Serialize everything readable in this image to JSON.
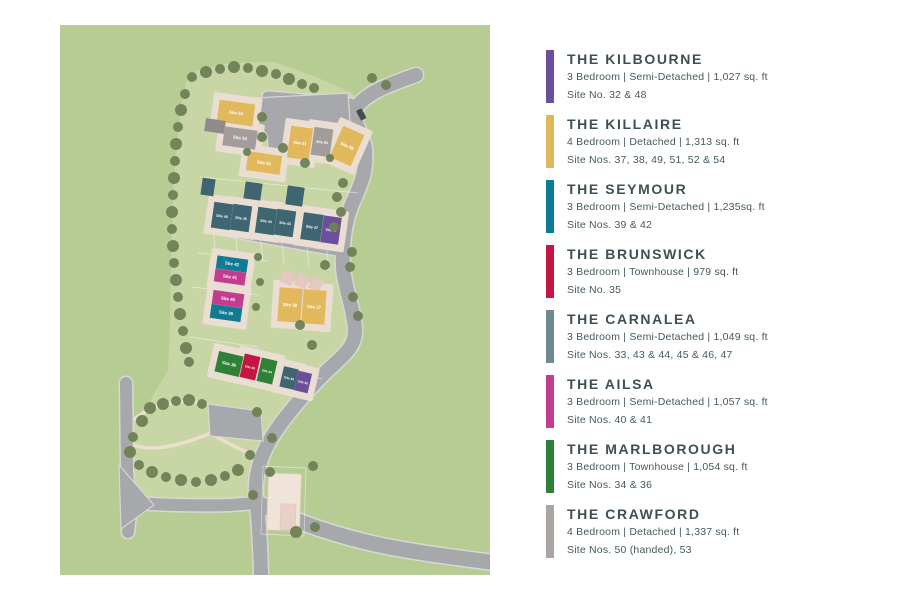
{
  "legend": {
    "items": [
      {
        "name": "THE KILBOURNE",
        "specs": "3 Bedroom | Semi-Detached | 1,027 sq. ft",
        "sites": "Site No. 32 & 48",
        "color": "#6a4f9a"
      },
      {
        "name": "THE KILLAIRE",
        "specs": "4 Bedroom | Detached | 1,313 sq. ft",
        "sites": "Site Nos. 37, 38, 49, 51, 52 & 54",
        "color": "#e0b85c"
      },
      {
        "name": "THE SEYMOUR",
        "specs": "3 Bedroom | Semi-Detached | 1,235sq. ft",
        "sites": "Site Nos. 39 & 42",
        "color": "#0b7a94"
      },
      {
        "name": "THE BRUNSWICK",
        "specs": "3 Bedroom | Townhouse | 979 sq. ft",
        "sites": "Site No. 35",
        "color": "#c51544"
      },
      {
        "name": "THE CARNALEA",
        "specs": "3 Bedroom | Semi-Detached | 1,049 sq. ft",
        "sites": "Site Nos. 33, 43 & 44, 45 & 46, 47",
        "color": "#6c8a8f"
      },
      {
        "name": "THE AILSA",
        "specs": "3 Bedroom | Semi-Detached | 1,057 sq. ft",
        "sites": "Site Nos. 40 & 41",
        "color": "#c23d8f"
      },
      {
        "name": "THE MARLBOROUGH",
        "specs": "3 Bedroom | Townhouse | 1,054 sq. ft",
        "sites": "Site Nos. 34 & 36",
        "color": "#2c8136"
      },
      {
        "name": "THE CRAWFORD",
        "specs": "4 Bedroom | Detached | 1,337 sq. ft",
        "sites": "Site Nos. 50 (handed), 53",
        "color": "#aaa5a3"
      }
    ]
  },
  "map": {
    "colors": {
      "kilbourne": "#6a4f9a",
      "killaire": "#e2b85c",
      "seymour": "#0e7b93",
      "brunswick": "#c51544",
      "carnalea": "#3f6472",
      "ailsa": "#c33d8f",
      "marlborough": "#2e8136",
      "crawford": "#a29d9b",
      "garage_gray": "#908b89",
      "garage_slate": "#3f6472",
      "garage_pink": "#e5c8c0",
      "existing": "#f0e4d9",
      "existing_annex": "#e9d0c7",
      "pad": "#eaddd2",
      "tree": "#6e7f54",
      "grass_outer": "#b7cc93",
      "grass_site": "#c8d6a6",
      "road": "#a7a8ab",
      "road_edge": "#d8d8d2",
      "path": "#ecdfcc",
      "label_text": "#ffffff",
      "car": "#474b51"
    },
    "houses": [
      {
        "label": "Site 54",
        "type": "killaire",
        "cx": 176,
        "cy": 88,
        "w": 36,
        "h": 22,
        "rot": 8
      },
      {
        "label": "",
        "type": "garage_gray",
        "cx": 155,
        "cy": 101,
        "w": 20,
        "h": 13,
        "rot": 8
      },
      {
        "label": "Site 53",
        "type": "crawford",
        "cx": 180,
        "cy": 113,
        "w": 33,
        "h": 19,
        "rot": 8
      },
      {
        "label": "Site 52",
        "type": "killaire",
        "cx": 204,
        "cy": 138,
        "w": 34,
        "h": 19,
        "rot": 8
      },
      {
        "label": "Site 51",
        "type": "killaire",
        "cx": 240,
        "cy": 118,
        "w": 22,
        "h": 32,
        "rot": 8
      },
      {
        "label": "Site 50",
        "type": "crawford",
        "cx": 262,
        "cy": 117,
        "w": 19,
        "h": 28,
        "rot": 8
      },
      {
        "label": "Site 49",
        "type": "killaire",
        "cx": 287,
        "cy": 121,
        "w": 23,
        "h": 34,
        "rot": 24
      },
      {
        "label": "",
        "type": "garage_slate",
        "cx": 148,
        "cy": 162,
        "w": 13,
        "h": 17,
        "rot": 8
      },
      {
        "label": "",
        "type": "garage_slate",
        "cx": 193,
        "cy": 166,
        "w": 17,
        "h": 17,
        "rot": 8
      },
      {
        "label": "",
        "type": "garage_slate",
        "cx": 235,
        "cy": 171,
        "w": 17,
        "h": 19,
        "rot": 8
      },
      {
        "label": "Site 46",
        "type": "carnalea",
        "cx": 162,
        "cy": 191,
        "w": 19,
        "h": 26,
        "rot": 8
      },
      {
        "label": "Site 45",
        "type": "carnalea",
        "cx": 181,
        "cy": 193,
        "w": 19,
        "h": 26,
        "rot": 8
      },
      {
        "label": "Site 44",
        "type": "carnalea",
        "cx": 206,
        "cy": 196,
        "w": 19,
        "h": 26,
        "rot": 8
      },
      {
        "label": "Site 43",
        "type": "carnalea",
        "cx": 225,
        "cy": 198,
        "w": 19,
        "h": 26,
        "rot": 8
      },
      {
        "label": "Site 47",
        "type": "carnalea",
        "cx": 252,
        "cy": 202,
        "w": 20,
        "h": 27,
        "rot": 8
      },
      {
        "label": "Site 48",
        "type": "kilbourne",
        "cx": 271,
        "cy": 205,
        "w": 18,
        "h": 27,
        "rot": 8
      },
      {
        "label": "Site 42",
        "type": "seymour",
        "cx": 172,
        "cy": 239,
        "w": 31,
        "h": 13,
        "rot": 8
      },
      {
        "label": "Site 41",
        "type": "ailsa",
        "cx": 170,
        "cy": 252,
        "w": 31,
        "h": 13,
        "rot": 8
      },
      {
        "label": "Site 40",
        "type": "ailsa",
        "cx": 168,
        "cy": 274,
        "w": 31,
        "h": 14,
        "rot": 8
      },
      {
        "label": "Site 39",
        "type": "seymour",
        "cx": 166,
        "cy": 288,
        "w": 31,
        "h": 14,
        "rot": 8
      },
      {
        "label": "",
        "type": "garage_pink",
        "cx": 228,
        "cy": 253,
        "w": 12,
        "h": 13,
        "rot": 25
      },
      {
        "label": "",
        "type": "garage_pink",
        "cx": 242,
        "cy": 256,
        "w": 12,
        "h": 13,
        "rot": 25
      },
      {
        "label": "",
        "type": "garage_pink",
        "cx": 256,
        "cy": 259,
        "w": 12,
        "h": 13,
        "rot": 25
      },
      {
        "label": "Site 38",
        "type": "killaire",
        "cx": 230,
        "cy": 280,
        "w": 23,
        "h": 34,
        "rot": 4
      },
      {
        "label": "Site 37",
        "type": "killaire",
        "cx": 254,
        "cy": 282,
        "w": 23,
        "h": 34,
        "rot": 4
      },
      {
        "label": "Site 36",
        "type": "marlborough",
        "cx": 169,
        "cy": 339,
        "w": 25,
        "h": 21,
        "rot": 13
      },
      {
        "label": "Site 35",
        "type": "brunswick",
        "cx": 190,
        "cy": 342,
        "w": 16,
        "h": 24,
        "rot": 13
      },
      {
        "label": "Site 34",
        "type": "marlborough",
        "cx": 207,
        "cy": 346,
        "w": 16,
        "h": 24,
        "rot": 13
      },
      {
        "label": "Site 33",
        "type": "carnalea",
        "cx": 229,
        "cy": 353,
        "w": 15,
        "h": 21,
        "rot": 13
      },
      {
        "label": "Site 32",
        "type": "kilbourne",
        "cx": 243,
        "cy": 357,
        "w": 14,
        "h": 20,
        "rot": 13
      },
      {
        "label": "",
        "type": "existing",
        "cx": 224,
        "cy": 477,
        "w": 33,
        "h": 57,
        "rot": 2
      },
      {
        "label": "",
        "type": "existing_annex",
        "cx": 228,
        "cy": 492,
        "w": 15,
        "h": 26,
        "rot": 2
      }
    ]
  }
}
